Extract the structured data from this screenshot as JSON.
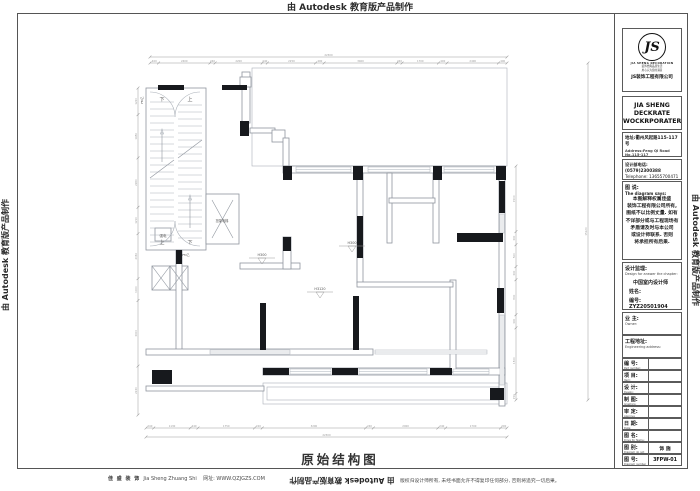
{
  "watermarks": {
    "top": "由 Autodesk 教育版产品制作",
    "left": "由 Autodesk 教育版产品制作",
    "right": "由 Autodesk 教育版产品制作",
    "bottom_flipped": "由 Autodesk 教育版产品制作"
  },
  "footer": {
    "brand_cn": "佳 盛 装 饰",
    "brand_en": "Jia Sheng Zhuang Shi",
    "site": "网址: WWW.QZJGZS.COM",
    "copyright": "版权归设计师所有, 未经书面允许不得复印任何部分, 否则将追究一切后果。"
  },
  "title_block": {
    "logo": {
      "monogram": "JS",
      "brand_en": "JIA SHENG DECORATION",
      "slogan1": "装饰经典品质生活",
      "slogan2": "用心只为您的满意",
      "company_cn": "JS装饰工程有限公司"
    },
    "company_line1": "JIA SHENG DECKRATE",
    "company_line2": "WOCKRPORATERKS",
    "address_cn": "地址:衢州风起路115-117号",
    "address_en": "Address:Feng Qi Road No.115-117",
    "phone_cn": "设计部电话: (0579)2300388",
    "phone_en": "Telephone: 13655700471",
    "diagram_says_cn": "图 说:",
    "diagram_says_en": "The diagram says:",
    "notice_lines": [
      "本图解释权属佳盛",
      "装饰工程有限公司所有,",
      "图纸不以比例丈量. 如有",
      "不详部分或与工程现场有",
      "矛盾请及时与本公司",
      "或设计师联系. 否则",
      "将承担所有后果."
    ],
    "supervision": {
      "label_cn": "设计监理:",
      "label_en": "Design for answer the chapter:",
      "line1": "中国室内设计师",
      "line2": "姓名:",
      "line3": "编号: ZYZ20501904"
    },
    "owner": {
      "cn": "业 主:",
      "en": "Owner:"
    },
    "eng_addr": {
      "cn": "工程地址:",
      "en": "Engineering address:"
    },
    "rows": [
      {
        "cn": "编 号:",
        "en": "Part number:",
        "value": ""
      },
      {
        "cn": "项 目:",
        "en": "Item:",
        "value": ""
      },
      {
        "cn": "设 计:",
        "en": "Design:",
        "value": ""
      },
      {
        "cn": "制 图:",
        "en": "Graphics:",
        "value": ""
      },
      {
        "cn": "审 定:",
        "en": "Approve officially:",
        "value": ""
      },
      {
        "cn": "日 期:",
        "en": "Date:",
        "value": ""
      },
      {
        "cn": "图 名:",
        "en": "Drive for Name:",
        "value": ""
      },
      {
        "cn": "图 别:",
        "en": "Diagram do not",
        "value": "饰 施"
      },
      {
        "cn": "图 号:",
        "en": "Diagram number",
        "value": "3FPW-01"
      }
    ]
  },
  "plan": {
    "title": "原始结构图",
    "colors": {
      "wall": "#8f959e",
      "thin": "#aab0b8",
      "column": "#17191d",
      "dim": "#9a9a9a",
      "text": "#555555"
    },
    "geometry": {
      "thin_rects": [
        [
          252,
          68,
          255,
          98
        ],
        [
          212,
          200,
          21,
          38
        ],
        [
          174,
          96,
          4,
          148
        ],
        [
          263,
          383,
          244,
          21
        ],
        [
          267,
          387,
          236,
          13
        ]
      ],
      "walls": [
        [
          146,
          88,
          60,
          162
        ],
        [
          206,
          194,
          33,
          50
        ],
        [
          152,
          266,
          18,
          24
        ],
        [
          170,
          266,
          18,
          24
        ],
        [
          155,
          228,
          16,
          13
        ],
        [
          242,
          72,
          8,
          51
        ],
        [
          240,
          77,
          11,
          10
        ],
        [
          250,
          128,
          25,
          5
        ],
        [
          272,
          130,
          13,
          12
        ],
        [
          283,
          138,
          6,
          28
        ],
        [
          283,
          166,
          222,
          7
        ],
        [
          499,
          166,
          6,
          240
        ],
        [
          357,
          173,
          6,
          110
        ],
        [
          387,
          173,
          5,
          70
        ],
        [
          433,
          173,
          6,
          70
        ],
        [
          389,
          198,
          46,
          5
        ],
        [
          240,
          263,
          60,
          6
        ],
        [
          176,
          250,
          6,
          103
        ],
        [
          146,
          349,
          227,
          6
        ],
        [
          146,
          386,
          118,
          5
        ],
        [
          263,
          368,
          242,
          7
        ],
        [
          450,
          280,
          6,
          92
        ],
        [
          357,
          282,
          96,
          5
        ],
        [
          283,
          237,
          8,
          32
        ]
      ],
      "columns": [
        [
          158,
          85,
          26,
          5
        ],
        [
          222,
          85,
          25,
          5
        ],
        [
          240,
          121,
          9,
          15
        ],
        [
          283,
          166,
          9,
          14
        ],
        [
          353,
          166,
          10,
          14
        ],
        [
          433,
          166,
          9,
          14
        ],
        [
          496,
          166,
          10,
          14
        ],
        [
          499,
          181,
          6,
          32
        ],
        [
          457,
          233,
          46,
          9
        ],
        [
          283,
          237,
          8,
          14
        ],
        [
          357,
          216,
          6,
          42
        ],
        [
          260,
          303,
          6,
          47
        ],
        [
          353,
          296,
          6,
          54
        ],
        [
          263,
          368,
          26,
          7
        ],
        [
          332,
          368,
          26,
          7
        ],
        [
          430,
          368,
          22,
          7
        ],
        [
          490,
          388,
          14,
          12
        ],
        [
          497,
          288,
          7,
          25
        ],
        [
          152,
          370,
          20,
          14
        ],
        [
          176,
          250,
          6,
          14
        ]
      ],
      "windows": [
        [
          296,
          167,
          55,
          5,
          "h"
        ],
        [
          368,
          167,
          62,
          5,
          "h"
        ],
        [
          444,
          167,
          50,
          5,
          "h"
        ],
        [
          500,
          214,
          4,
          19,
          "v"
        ],
        [
          500,
          315,
          4,
          70,
          "v"
        ],
        [
          290,
          369,
          41,
          5,
          "h"
        ],
        [
          359,
          369,
          68,
          5,
          "h"
        ],
        [
          453,
          369,
          36,
          5,
          "h"
        ],
        [
          210,
          350,
          80,
          4,
          "h"
        ],
        [
          375,
          350,
          112,
          4,
          "h"
        ]
      ],
      "lines": [
        [
          212,
          200,
          233,
          238
        ],
        [
          233,
          200,
          212,
          238
        ],
        [
          152,
          266,
          170,
          290
        ],
        [
          170,
          266,
          152,
          290
        ],
        [
          170,
          266,
          188,
          290
        ],
        [
          188,
          266,
          170,
          290
        ],
        [
          150,
          178,
          174,
          160
        ],
        [
          178,
          158,
          202,
          140
        ],
        [
          162,
          162,
          162,
          132
        ],
        [
          190,
          228,
          190,
          198
        ]
      ],
      "paths": [
        "M150,92 A25,25 0 0 1 175,117",
        "M200,92 A25,25 0 0 0 175,117",
        "M150,246 A25,25 0 0 0 175,221",
        "M200,246 A25,25 0 0 1 175,221",
        "M160.5,134 L162,129 L163.5,134 Z",
        "M188.5,200 L190,195 L191.5,200 Z"
      ],
      "stairs": {
        "x1": 150,
        "x2": 174,
        "x3": 178,
        "x4": 202,
        "y0": 102,
        "y1": 244,
        "step": 7
      },
      "texts": [
        [
          222,
          222,
          "担架电梯",
          3.2,
          0
        ],
        [
          163,
          237,
          "强电",
          3.5,
          0
        ],
        [
          162,
          101,
          "下",
          5,
          0
        ],
        [
          190,
          101,
          "上",
          5,
          0
        ],
        [
          162,
          244,
          "上",
          5,
          0
        ],
        [
          190,
          244,
          "下",
          5,
          0
        ],
        [
          143,
          100,
          "FM乙",
          3,
          -90
        ],
        [
          186,
          256,
          "FM乙",
          3,
          0
        ]
      ],
      "markers": [
        [
          262,
          256,
          "H300"
        ],
        [
          352,
          244,
          "H300"
        ],
        [
          320,
          290,
          "H3120"
        ]
      ],
      "dims": [
        {
          "type": "h",
          "pos": 57,
          "from": 150,
          "to": 507,
          "labels": [
            "22300"
          ]
        },
        {
          "type": "h",
          "pos": 63,
          "from": 150,
          "to": 507,
          "labels": [
            "400",
            "2400",
            "240",
            "2200",
            "240",
            "2250",
            "400",
            "3400",
            "240",
            "1700",
            "400",
            "2400",
            "400"
          ]
        },
        {
          "type": "h",
          "pos": 428,
          "from": 146,
          "to": 507,
          "labels": [
            "240",
            "1130",
            "240",
            "1750",
            "240",
            "3200",
            "240",
            "2000",
            "240",
            "1700",
            "200"
          ]
        },
        {
          "type": "h",
          "pos": 437,
          "from": 146,
          "to": 507,
          "labels": [
            "22300"
          ]
        },
        {
          "type": "v",
          "pos": 138,
          "from": 88,
          "to": 415,
          "labels": [
            "1220",
            "1980",
            "2260",
            "1210",
            "2060",
            "1000",
            "3000",
            "2240"
          ]
        },
        {
          "type": "v",
          "pos": 516,
          "from": 166,
          "to": 400,
          "labels": [
            "1500",
            "300",
            "500",
            "300",
            "800",
            "300",
            "1500",
            "150"
          ]
        },
        {
          "type": "v",
          "pos": 588,
          "from": 63,
          "to": 400,
          "labels": [
            "15120"
          ]
        }
      ]
    }
  }
}
